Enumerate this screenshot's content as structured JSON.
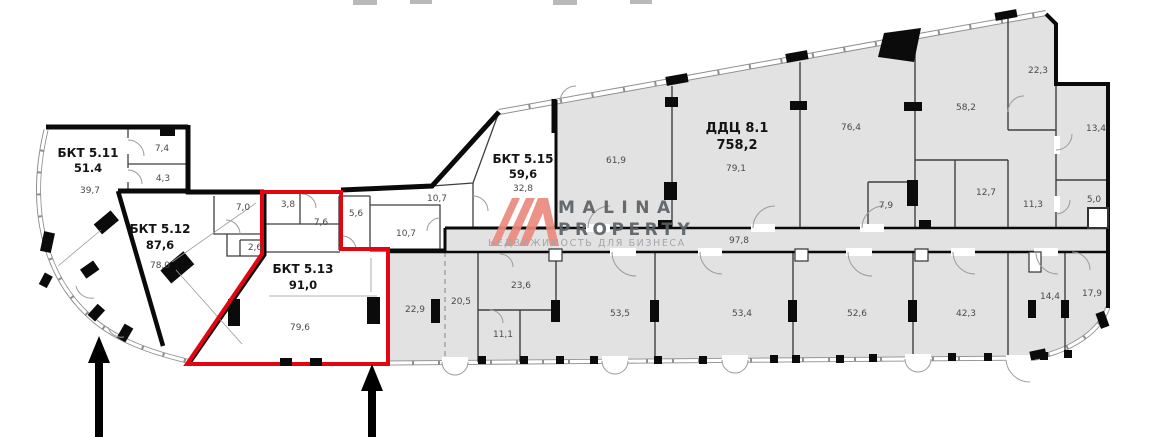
{
  "watermark": {
    "brand_line1": "MALINA",
    "brand_line2": "PROPERTY",
    "tagline": "НЕДВИЖИМОСТЬ ДЛЯ БИЗНЕСА"
  },
  "colors": {
    "highlight_red": "#e30611",
    "plan_gray": "#e2e2e2",
    "logo_salmon": "#eb8a7e"
  },
  "plan": {
    "units": [
      {
        "name": "БКТ 5.11",
        "area": "51.4",
        "highlighted": false
      },
      {
        "name": "БКТ 5.12",
        "area": "87,6",
        "highlighted": false
      },
      {
        "name": "БКТ 5.13",
        "area": "91,0",
        "highlighted": true
      },
      {
        "name": "БКТ 5.15",
        "area": "59,6",
        "highlighted": false
      },
      {
        "name": "ДДЦ 8.1",
        "area": "758,2",
        "highlighted": false
      }
    ],
    "rooms": [
      {
        "label": "7,4",
        "x": 162,
        "y": 151
      },
      {
        "label": "4,3",
        "x": 163,
        "y": 181
      },
      {
        "label": "39,7",
        "x": 90,
        "y": 193
      },
      {
        "label": "78,0",
        "x": 160,
        "y": 268
      },
      {
        "label": "7,0",
        "x": 243,
        "y": 210
      },
      {
        "label": "2,6",
        "x": 255,
        "y": 250
      },
      {
        "label": "3,8",
        "x": 288,
        "y": 207
      },
      {
        "label": "7,6",
        "x": 321,
        "y": 225
      },
      {
        "label": "79,6",
        "x": 300,
        "y": 330
      },
      {
        "label": "5,6",
        "x": 356,
        "y": 216
      },
      {
        "label": "10,7",
        "x": 437,
        "y": 201
      },
      {
        "label": "10,7",
        "x": 406,
        "y": 236
      },
      {
        "label": "32,8",
        "x": 523,
        "y": 191
      },
      {
        "label": "61,9",
        "x": 616,
        "y": 163
      },
      {
        "label": "79,1",
        "x": 736,
        "y": 171
      },
      {
        "label": "76,4",
        "x": 851,
        "y": 130
      },
      {
        "label": "58,2",
        "x": 966,
        "y": 110
      },
      {
        "label": "22,3",
        "x": 1038,
        "y": 73
      },
      {
        "label": "13,4",
        "x": 1096,
        "y": 131
      },
      {
        "label": "12,7",
        "x": 986,
        "y": 195
      },
      {
        "label": "11,3",
        "x": 1033,
        "y": 207
      },
      {
        "label": "7,9",
        "x": 886,
        "y": 208
      },
      {
        "label": "5,0",
        "x": 1094,
        "y": 202
      },
      {
        "label": "97,8",
        "x": 739,
        "y": 243
      },
      {
        "label": "22,9",
        "x": 415,
        "y": 312
      },
      {
        "label": "20,5",
        "x": 461,
        "y": 304
      },
      {
        "label": "23,6",
        "x": 521,
        "y": 288
      },
      {
        "label": "11,1",
        "x": 503,
        "y": 337
      },
      {
        "label": "53,5",
        "x": 620,
        "y": 316
      },
      {
        "label": "53,4",
        "x": 742,
        "y": 316
      },
      {
        "label": "52,6",
        "x": 857,
        "y": 316
      },
      {
        "label": "42,3",
        "x": 966,
        "y": 316
      },
      {
        "label": "14,4",
        "x": 1050,
        "y": 299
      },
      {
        "label": "17,9",
        "x": 1092,
        "y": 296
      }
    ]
  }
}
